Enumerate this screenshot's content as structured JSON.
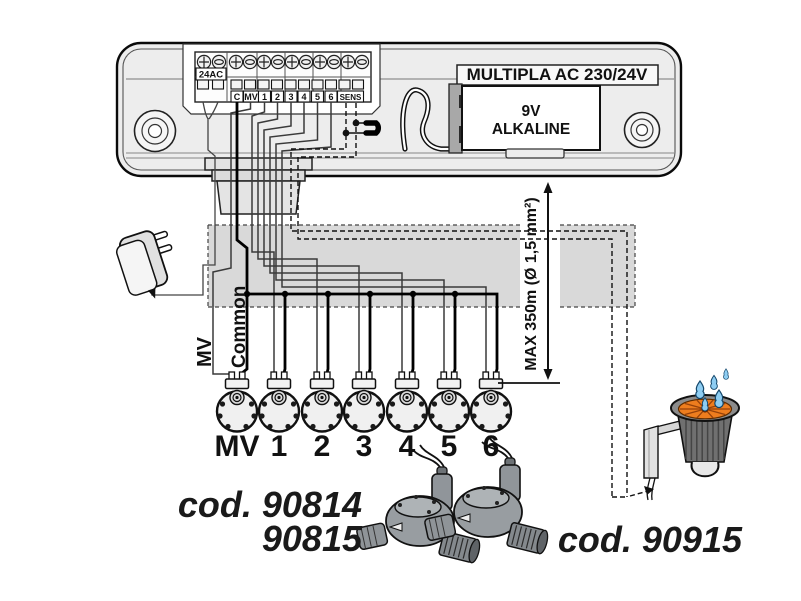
{
  "diagram": {
    "controller": {
      "model": "MULTIPLA AC 230/24V",
      "battery": {
        "line1": "9V",
        "line2": "ALKALINE"
      },
      "power_input_label": "24AC",
      "terminal_labels": [
        "C",
        "MV",
        "1",
        "2",
        "3",
        "4",
        "5",
        "6",
        "SENS"
      ]
    },
    "wiring": {
      "mv_label": "MV",
      "common_label": "Common",
      "max_run_label": "MAX 350m (Ø 1,5 mm²)"
    },
    "valves": {
      "station_labels": [
        "MV",
        "1",
        "2",
        "3",
        "4",
        "5",
        "6"
      ],
      "code_line1": "cod. 90814",
      "code_line2": "90815"
    },
    "rain_sensor": {
      "code": "cod. 90915"
    },
    "colors": {
      "conduit_band": "#d9d9d9",
      "case_fill": "#ededed",
      "sensor_orange": "#ee7d1e",
      "drop_blue": "#8ecdf2"
    }
  }
}
